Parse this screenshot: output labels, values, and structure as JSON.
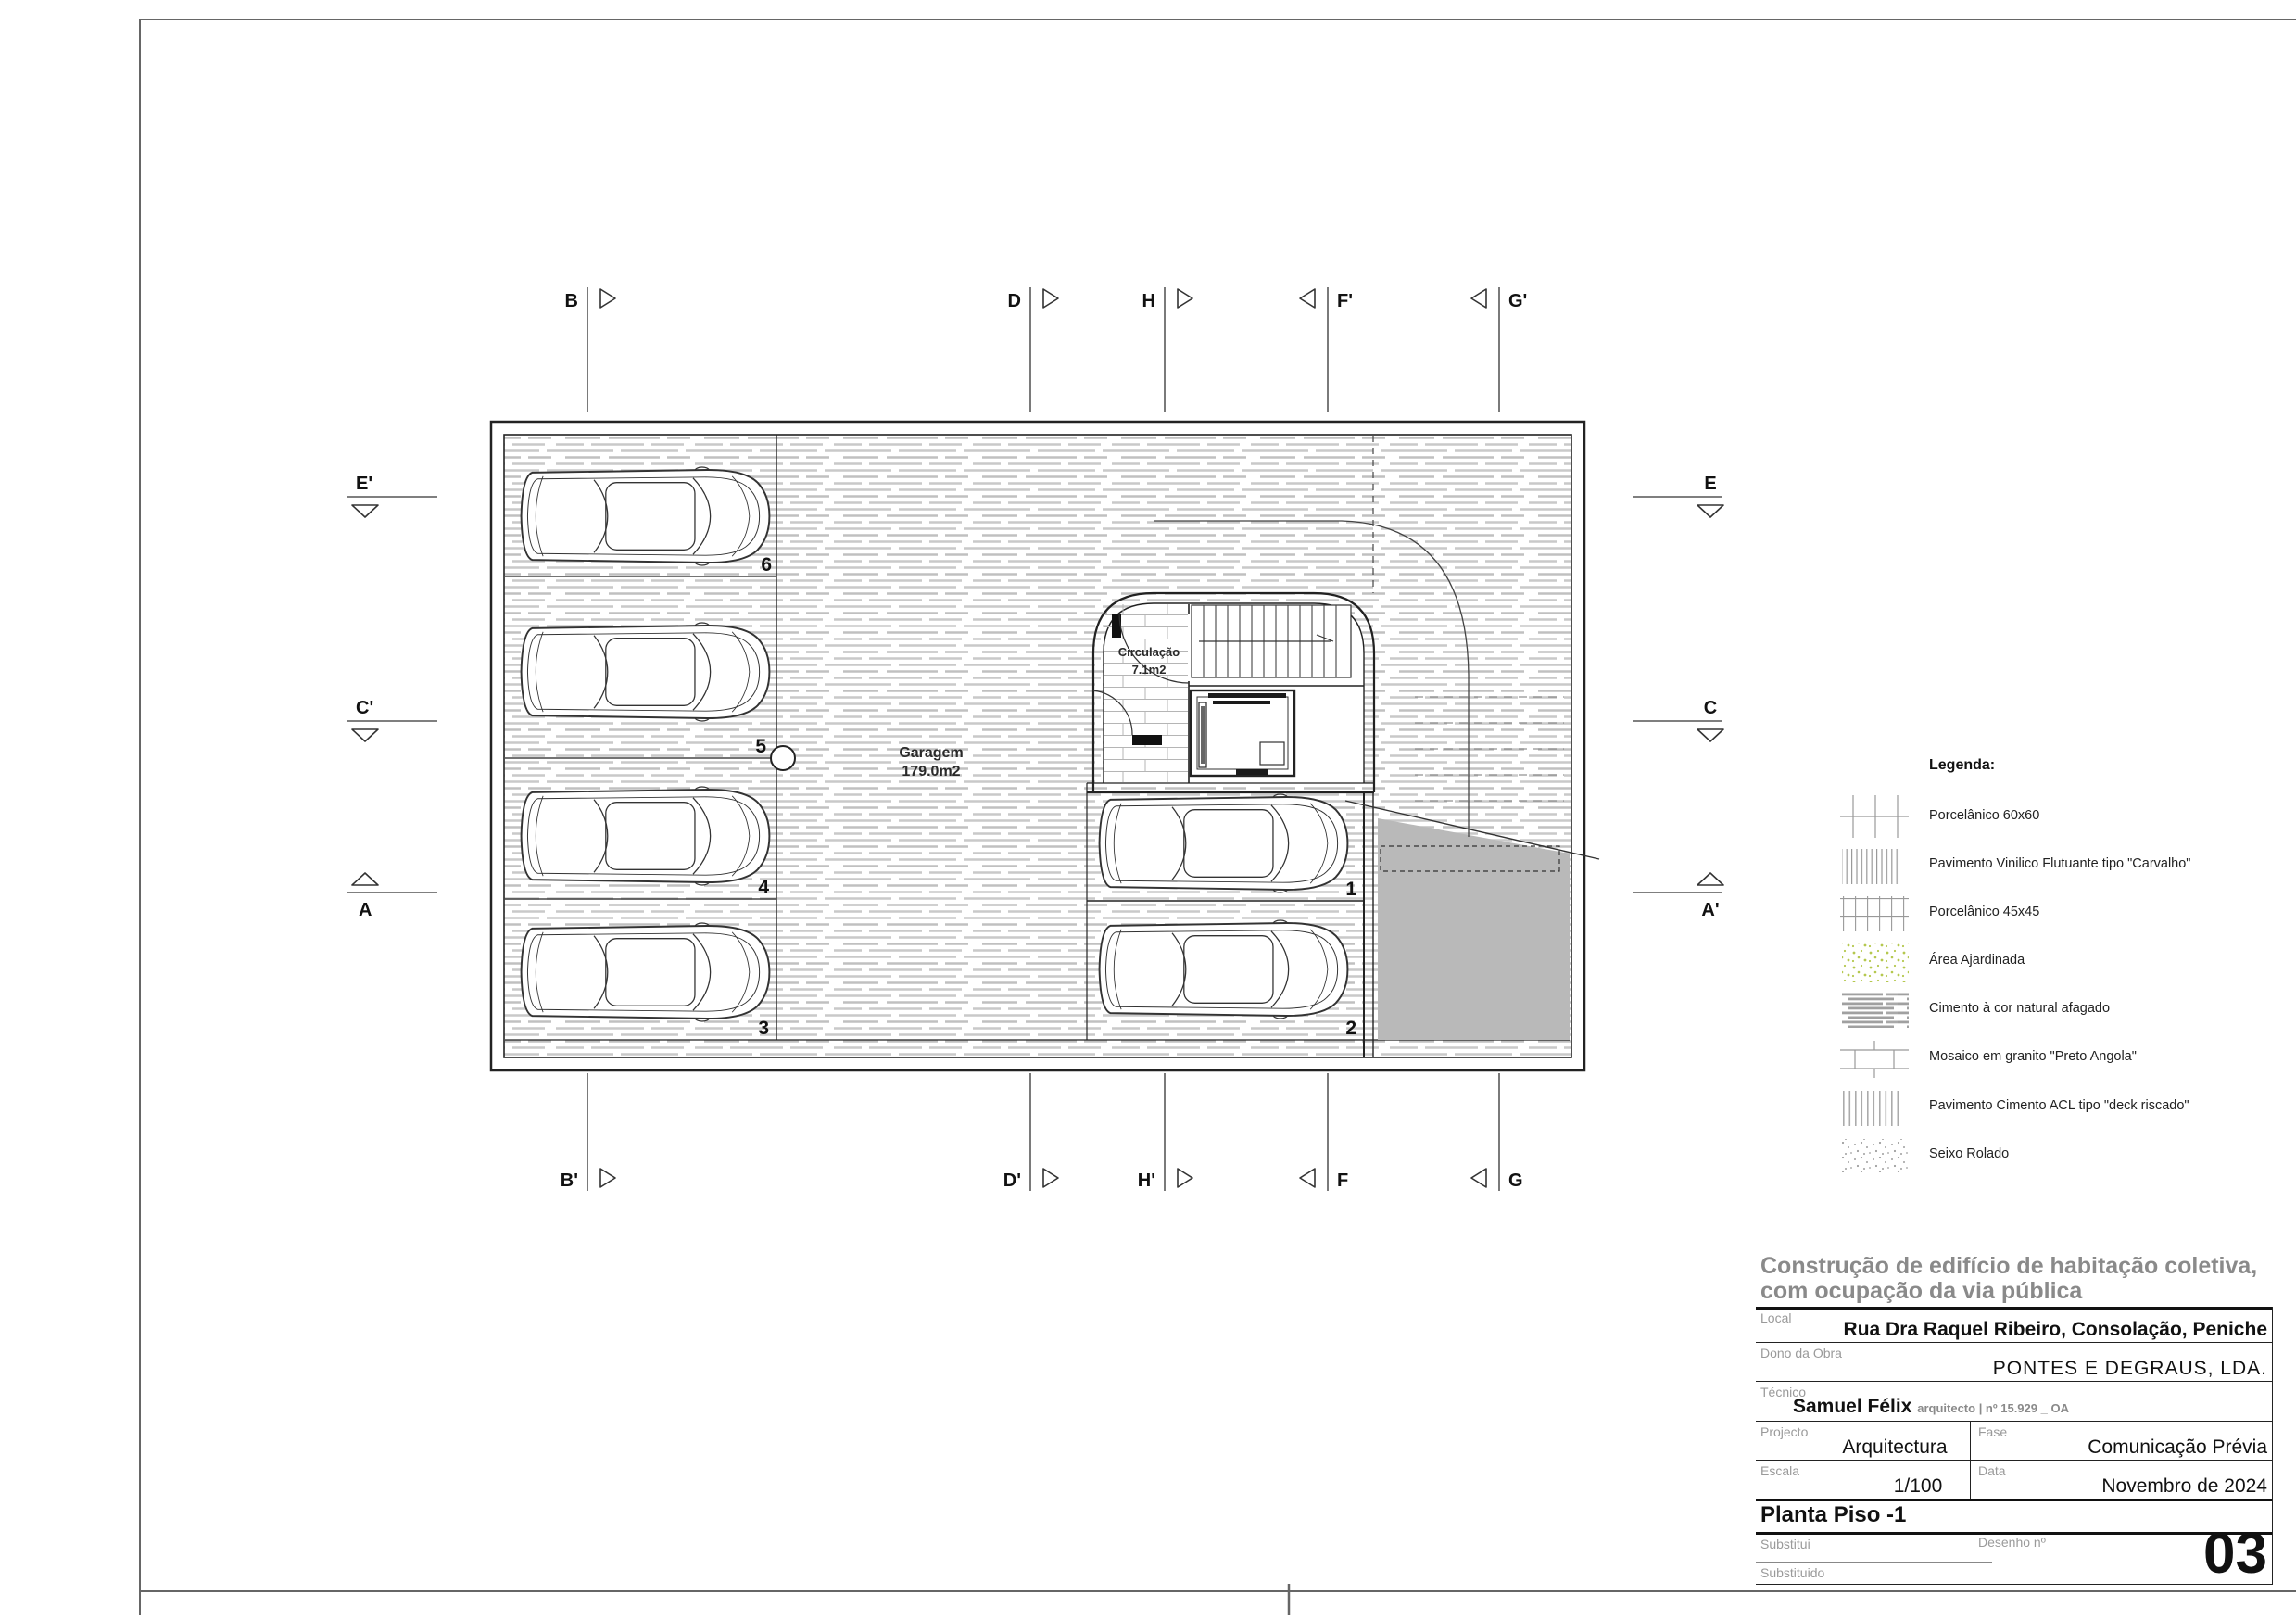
{
  "plan": {
    "garage": {
      "name": "Garagem",
      "area": "179.0m2"
    },
    "circulation": {
      "name": "Circulação",
      "area": "7.1m2"
    },
    "stalls": [
      "6",
      "5",
      "4",
      "3",
      "1",
      "2"
    ],
    "markers": {
      "top": [
        "B",
        "D",
        "H",
        "F'",
        "G'"
      ],
      "bottom": [
        "B'",
        "D'",
        "H'",
        "F",
        "G"
      ],
      "left": [
        "E'",
        "C'",
        "A"
      ],
      "right": [
        "E",
        "C",
        "A'"
      ]
    }
  },
  "legend": {
    "title": "Legenda:",
    "items": [
      {
        "label": "Porcelânico 60x60",
        "swatch": "grid-60x60-swatch"
      },
      {
        "label": "Pavimento Vinilico Flutuante tipo \"Carvalho\"",
        "swatch": "vertical-lines-swatch"
      },
      {
        "label": "Porcelânico 45x45",
        "swatch": "grid-45x45-swatch"
      },
      {
        "label": "Área Ajardinada",
        "swatch": "green-speckle-swatch"
      },
      {
        "label": "Cimento à cor natural afagado",
        "swatch": "horizontal-strokes-swatch"
      },
      {
        "label": "Mosaico em granito \"Preto Angola\"",
        "swatch": "brick-swatch"
      },
      {
        "label": "Pavimento Cimento ACL tipo \"deck riscado\"",
        "swatch": "gray-vertical-lines-swatch"
      },
      {
        "label": "Seixo Rolado",
        "swatch": "gray-speckle-swatch"
      }
    ]
  },
  "title_block": {
    "project_title_line1": "Construção de edifício de habitação coletiva,",
    "project_title_line2": "com ocupação da via pública",
    "local_label": "Local",
    "local_value": "Rua Dra Raquel Ribeiro, Consolação, Peniche",
    "dono_label": "Dono da Obra",
    "dono_value": "PONTES E DEGRAUS, LDA.",
    "tecnico_label": "Técnico",
    "tecnico_name": "Samuel Félix",
    "tecnico_credentials": "arquitecto | nº 15.929 _ OA",
    "projecto_label": "Projecto",
    "projecto_value": "Arquitectura",
    "fase_label": "Fase",
    "fase_value": "Comunicação Prévia",
    "escala_label": "Escala",
    "escala_value": "1/100",
    "data_label": "Data",
    "data_value": "Novembro de 2024",
    "drawing_name": "Planta Piso -1",
    "substitui_label": "Substitui",
    "substituido_label": "Substituido",
    "desenho_label": "Desenho nº",
    "desenho_value": "03"
  },
  "colors": {
    "ramp_gray": "#b9b9b9",
    "garden_green": "#b5c84f",
    "hatch_gray": "#c9c9c9",
    "title_gray": "#8a8a8a",
    "field_label_gray": "#9a9a9a",
    "wall_black": "#222222"
  }
}
